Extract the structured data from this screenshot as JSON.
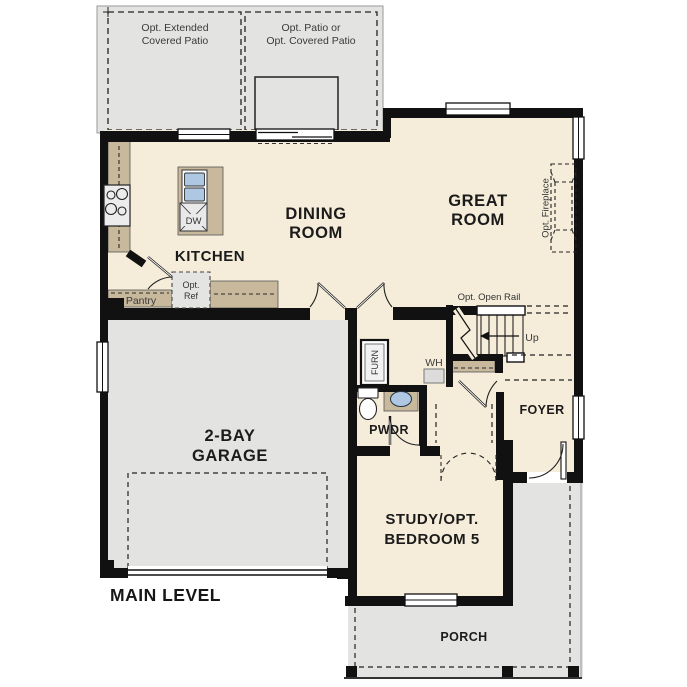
{
  "plan": {
    "title": "MAIN LEVEL",
    "rooms": {
      "dining": {
        "line1": "DINING",
        "line2": "ROOM"
      },
      "great": {
        "line1": "GREAT",
        "line2": "ROOM"
      },
      "kitchen": {
        "label": "KITCHEN"
      },
      "garage": {
        "line1": "2-BAY",
        "line2": "GARAGE"
      },
      "study": {
        "line1": "STUDY/OPT.",
        "line2": "BEDROOM 5"
      },
      "foyer": {
        "label": "FOYER"
      },
      "pwdr": {
        "label": "PWDR"
      },
      "porch": {
        "label": "PORCH"
      },
      "pantry": {
        "label": "Pantry"
      }
    },
    "annotations": {
      "opt_extended_patio": {
        "line1": "Opt. Extended",
        "line2": "Covered Patio"
      },
      "opt_patio": {
        "line1": "Opt. Patio or",
        "line2": "Opt. Covered Patio"
      },
      "opt_ref": {
        "line1": "Opt.",
        "line2": "Ref"
      },
      "opt_fireplace": "Opt. Fireplace",
      "opt_open_rail": "Opt. Open Rail",
      "up": "Up",
      "wh": "WH",
      "furn": "FURN",
      "dw": "DW"
    },
    "colors": {
      "floor": "#f5edda",
      "hardscape": "#e3e3e1",
      "counter": "#c8b89c",
      "sink_blue": "#aec7e3",
      "wall": "#111111"
    }
  }
}
